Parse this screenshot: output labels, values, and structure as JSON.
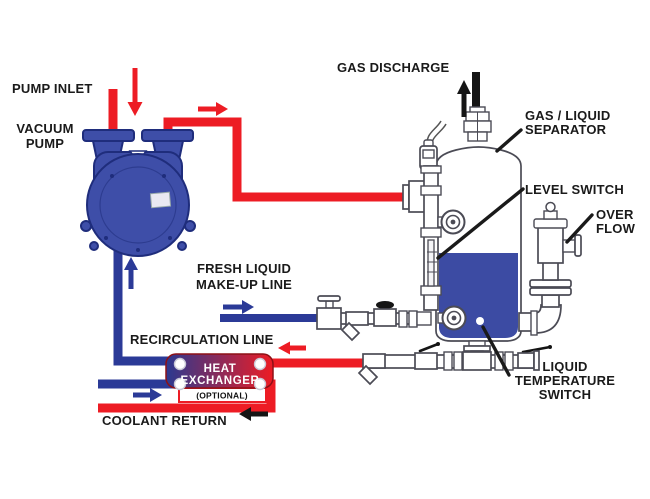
{
  "labels": {
    "pump_inlet": "PUMP INLET",
    "vacuum_pump_1": "VACUUM",
    "vacuum_pump_2": "PUMP",
    "gas_discharge": "GAS DISCHARGE",
    "separator_1": "GAS / LIQUID",
    "separator_2": "SEPARATOR",
    "level_switch": "LEVEL SWITCH",
    "overflow_1": "OVER",
    "overflow_2": "FLOW",
    "makeup_1": "FRESH LIQUID",
    "makeup_2": "MAKE-UP LINE",
    "recirculation": "RECIRCULATION LINE",
    "heat_exchanger_1": "HEAT",
    "heat_exchanger_2": "EXCHANGER",
    "heat_exchanger_3": "(OPTIONAL)",
    "coolant_return": "COOLANT RETURN",
    "temp_switch_1": "LIQUID",
    "temp_switch_2": "TEMPERATURE",
    "temp_switch_3": "SWITCH"
  },
  "colors": {
    "hot_line": "#ed1c24",
    "cold_line": "#2b3a97",
    "pump_body": "#3e4ea8",
    "pump_outline": "#1f2d7c",
    "tank_liquid": "#3c4ba3",
    "he_gradient_left": "#2b3990",
    "he_gradient_right": "#ed1c24",
    "label_ink": "#1a1a1a"
  }
}
